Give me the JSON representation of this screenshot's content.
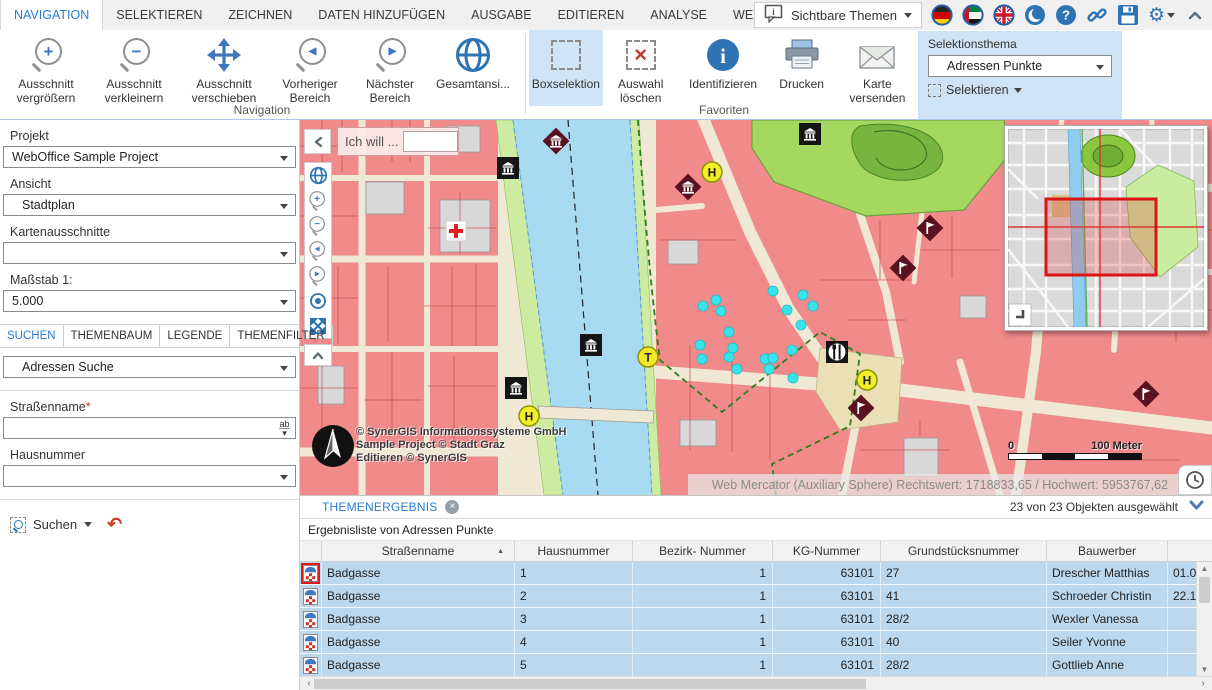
{
  "menu": {
    "tabs": [
      "NAVIGATION",
      "SELEKTIEREN",
      "ZEICHNEN",
      "DATEN HINZUFÜGEN",
      "AUSGABE",
      "EDITIEREN",
      "ANALYSE",
      "WEITERE WERKZEUGE"
    ],
    "visible_themes": "Sichtbare Themen"
  },
  "ribbon": {
    "navigation": {
      "label": "Navigation",
      "zoom_in": "Ausschnitt vergrößern",
      "zoom_out": "Ausschnitt verkleinern",
      "pan": "Ausschnitt verschieben",
      "previous": "Vorheriger Bereich",
      "next": "Nächster Bereich",
      "full_extent": "Gesamtansi..."
    },
    "favorites": {
      "label": "Favoriten",
      "box_selection": "Boxselektion",
      "clear_selection": "Auswahl löschen",
      "identify": "Identifizieren",
      "print": "Drucken",
      "send_map": "Karte versenden"
    },
    "selection_panel": {
      "title": "Selektionsthema",
      "theme": "Adressen Punkte",
      "select_button": "Selektieren"
    }
  },
  "sidebar": {
    "project_label": "Projekt",
    "project_value": "WebOffice Sample Project",
    "view_label": "Ansicht",
    "view_value": "Stadtplan",
    "extents_label": "Kartenausschnitte",
    "extents_value": "",
    "scale_label": "Maßstab 1:",
    "scale_value": "5.000",
    "tabs": [
      "SUCHEN",
      "THEMENBAUM",
      "LEGENDE",
      "THEMENFILTER"
    ],
    "search_theme": "Adressen Suche",
    "street_label": "Straßenname",
    "required_mark": "*",
    "house_label": "Hausnummer",
    "search_button": "Suchen"
  },
  "map": {
    "prompt": "Ich will ...",
    "hotel_letter": "H",
    "tram_letter": "T",
    "attribution_line1": "© SynerGIS Informationssysteme GmbH",
    "attribution_line2": "Sample Project © Stadt Graz",
    "attribution_line3": "Editieren © SynerGIS",
    "scale_zero": "0",
    "scale_text": "100 Meter",
    "statusbar": "Web Mercator (Auxiliary Sphere) Rechtswert: 1718833,65 / Hochwert: 5953767,62"
  },
  "results": {
    "tab": "THEMENERGEBNIS",
    "status": "23 von 23 Objekten ausgewählt",
    "subtitle": "Ergebnisliste von Adressen Punkte",
    "columns": [
      "Straßenname",
      "Hausnummer",
      "Bezirk- Nummer",
      "KG-Nummer",
      "Grundstücksnummer",
      "Bauwerber"
    ],
    "rows": [
      {
        "strasse": "Badgasse",
        "hausnummer": "1",
        "bezirk": "1",
        "kg": "63101",
        "grundstueck": "27",
        "bauwerber": "Drescher Matthias",
        "datum": "01.01",
        "highlight": true
      },
      {
        "strasse": "Badgasse",
        "hausnummer": "2",
        "bezirk": "1",
        "kg": "63101",
        "grundstueck": "41",
        "bauwerber": "Schroeder Christin",
        "datum": "22.12"
      },
      {
        "strasse": "Badgasse",
        "hausnummer": "3",
        "bezirk": "1",
        "kg": "63101",
        "grundstueck": "28/2",
        "bauwerber": "Wexler Vanessa",
        "datum": ""
      },
      {
        "strasse": "Badgasse",
        "hausnummer": "4",
        "bezirk": "1",
        "kg": "63101",
        "grundstueck": "40",
        "bauwerber": "Seiler Yvonne",
        "datum": ""
      },
      {
        "strasse": "Badgasse",
        "hausnummer": "5",
        "bezirk": "1",
        "kg": "63101",
        "grundstueck": "28/2",
        "bauwerber": "Gottlieb Anne",
        "datum": ""
      }
    ]
  }
}
